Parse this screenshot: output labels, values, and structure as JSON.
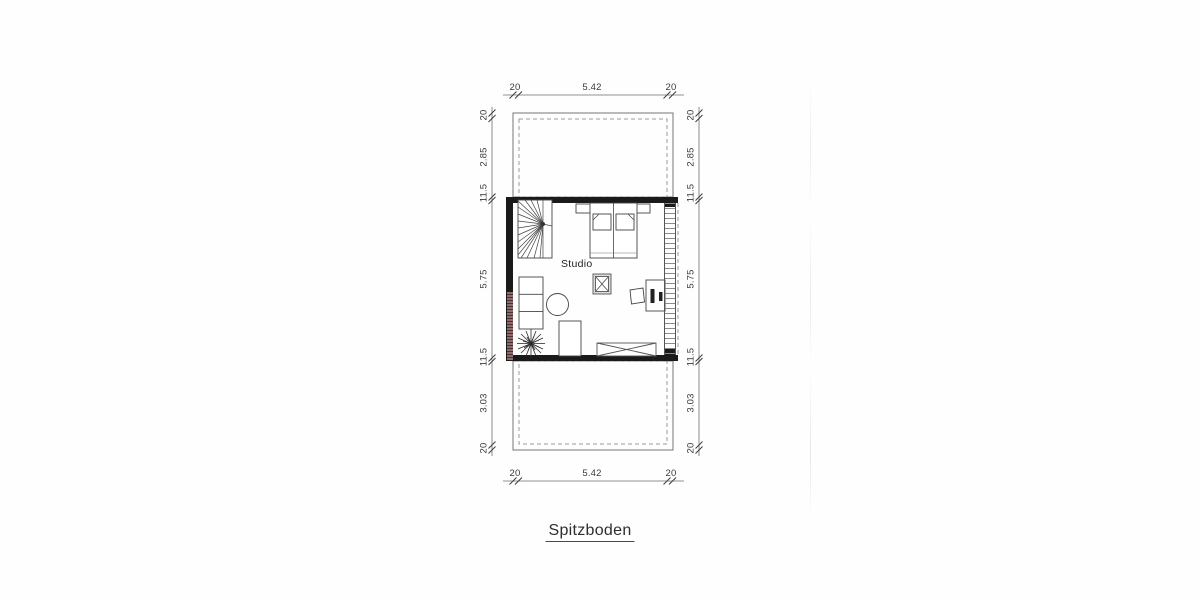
{
  "page": {
    "title_label": "Spitzboden",
    "room_label": "Studio"
  },
  "dimensions": {
    "top": [
      "20",
      "5.42",
      "20"
    ],
    "bottom": [
      "20",
      "5.42",
      "20"
    ],
    "left": [
      "20",
      "2.85",
      "11.5",
      "5.75",
      "11.5",
      "3.03",
      "20"
    ],
    "right": [
      "20",
      "2.85",
      "11.5",
      "5.75",
      "11.5",
      "3.03",
      "20"
    ]
  },
  "colors": {
    "wall": "#1a1a1a",
    "thin_line": "#666666",
    "dashed_line": "#999999",
    "furniture_line": "#444444",
    "text": "#333333",
    "watermark": "#bc8282"
  }
}
